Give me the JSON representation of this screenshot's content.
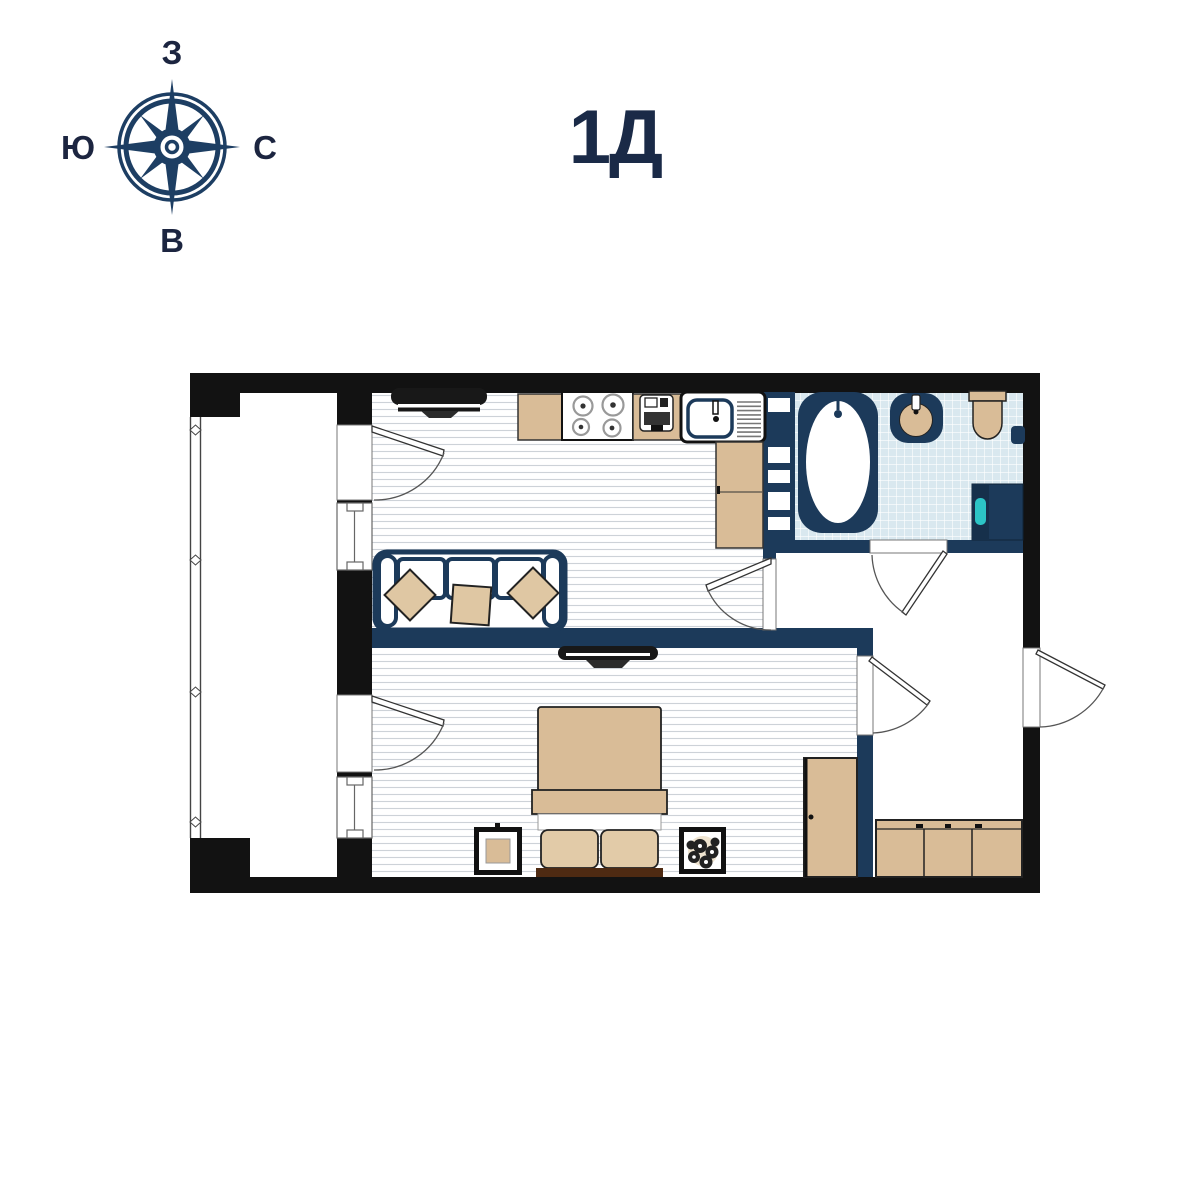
{
  "title": "1Д",
  "compass": {
    "top": "З",
    "right": "С",
    "bottom": "В",
    "left": "Ю"
  },
  "colors": {
    "wall_black": "#121212",
    "wall_navy": "#1c3a5a",
    "furniture_tan": "#d9bc97",
    "pillow_tan": "#dfc7a3",
    "tile_blue": "#d9e8ef",
    "floor_line_gray": "#cdd2d8",
    "bed_base_brown": "#4e2a12",
    "washer_accent_teal": "#2cc5c6",
    "title_navy": "#1a2a47",
    "compass_navy": "#1d3e63"
  },
  "icons": [
    "compass-rose-icon",
    "bathtub-icon",
    "bathroom-sink-icon",
    "toilet-icon",
    "washing-machine-icon",
    "stove-icon",
    "kitchen-sink-icon",
    "coffee-machine-icon",
    "tv-icon",
    "sofa-icon",
    "double-bed-icon",
    "wardrobe-icon",
    "plant-icon",
    "door-swing-icon",
    "window-icon"
  ]
}
